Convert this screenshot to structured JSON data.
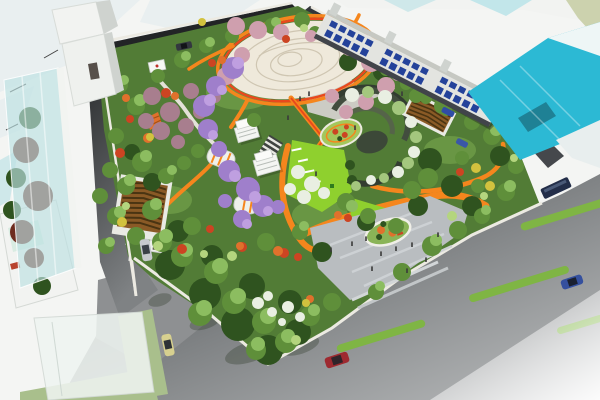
{
  "image": {
    "title": "Aerial 3D rendering of an urban pocket park master plan with surrounding streets and buildings",
    "type": "architectural-visualization",
    "visible_text": ""
  },
  "palette": {
    "background": "#f4f5f3",
    "facet_pale": "#e9eff0",
    "facet_teal": "#cfe8ea",
    "asphalt_darkest": "#222426",
    "asphalt_dark": "#3a3c3e",
    "asphalt_mid": "#7f8284",
    "asphalt_pale": "#bcbebf",
    "sidewalk": "#eceae2",
    "park_green": "#527c36",
    "park_green_dark": "#3c6124",
    "park_green_light": "#6f9c48",
    "canopy_dark": "#2f531f",
    "canopy_green": "#5f8f3a",
    "canopy_light": "#8cbd60",
    "canopy_pale": "#b4d57e",
    "blossom_pink": "#cf9fae",
    "blossom_mauve": "#a87e8e",
    "wisteria": "#9f7fcb",
    "wisteria_light": "#bf9fe0",
    "accent_red": "#cc4422",
    "accent_orange": "#e0712c",
    "accent_yellow": "#d2c23e",
    "white_bloom": "#e9efe2",
    "vine_green": "#a4c77e",
    "lawn_lime": "#8fd02e",
    "path_orange": "#f5861d",
    "path_red": "#e8491d",
    "path_grey": "#d8d6cc",
    "plaza_white": "#efe9db",
    "plaza_line": "#cfc6b2",
    "entry_plaza": "#b9bdc0",
    "entry_plaza_light": "#cdd1d4",
    "median_green": "#7fb544",
    "glass_teal": "#bce0e2",
    "glass_deep": "#2cb9d4",
    "building_white": "#f2f3f1",
    "building_face": "#e3e4e0",
    "building_shadow": "#cfd3cf",
    "window_blue": "#24429a",
    "wood_brown": "#8a5a26",
    "wood_dark": "#4a3412",
    "figure_dark": "#3a3a3a",
    "olive_corner": "#ccd2ae",
    "flower_bed_green": "#a3c75c",
    "island_green": "#8ab457"
  },
  "vehicles": [
    {
      "name": "sedan-dark-northwest-road",
      "color": "#33373f"
    },
    {
      "name": "sedan-silver-west-road",
      "color": "#c6c9ce"
    },
    {
      "name": "sedan-yellow-south-road",
      "color": "#d7d08f"
    },
    {
      "name": "sedan-red-avenue",
      "color": "#9e2a30"
    },
    {
      "name": "sedan-blue-avenue",
      "color": "#35509e"
    },
    {
      "name": "bus-dark-east-avenue",
      "color": "#232e49"
    },
    {
      "name": "car-blue-northeast-road",
      "color": "#2f4da6"
    },
    {
      "name": "car-blue-parked",
      "color": "#3a57a8"
    }
  ],
  "features": {
    "central_plaza": "oval paved plaza with concentric pattern",
    "ring_path": "orange-red loop path",
    "wisteria_tunnel": "purple vine covered tunnel",
    "event_lawn": "lime lawn with benches",
    "crescent_pergola": "spiral stepped pergola with vines",
    "entry_plaza": "grey entry plaza with planted island",
    "parking_shelter": "timber louvre roofed shelter"
  }
}
